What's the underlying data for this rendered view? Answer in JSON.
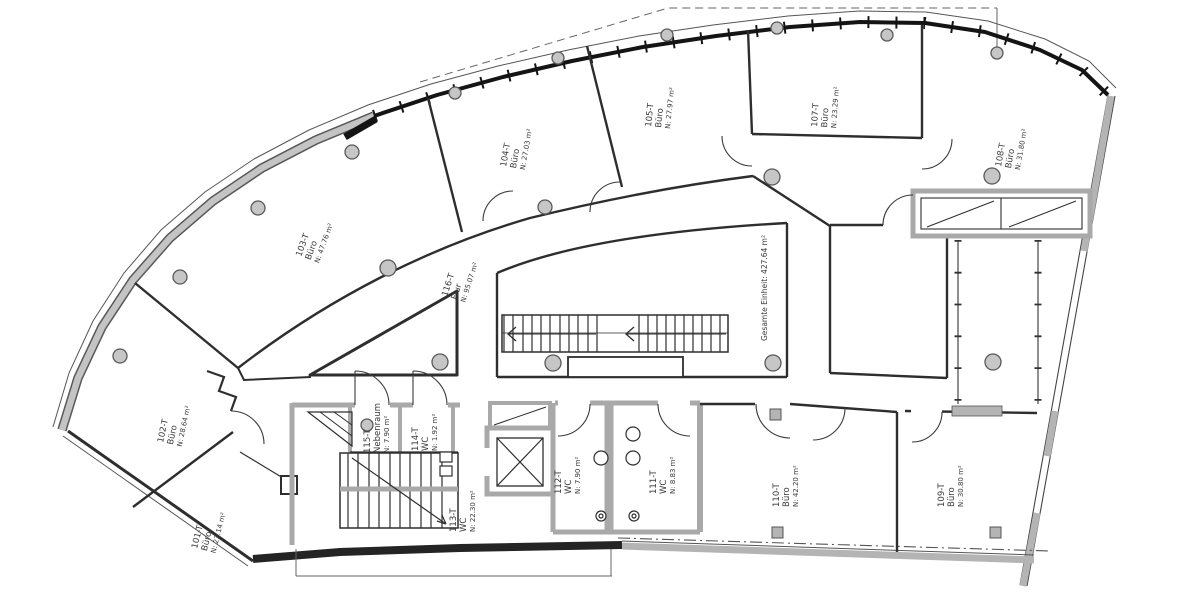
{
  "rooms": {
    "r101": {
      "id": "101-T",
      "type": "Büro",
      "area": "N: 23.14 m²"
    },
    "r102": {
      "id": "102-T",
      "type": "Büro",
      "area": "N: 28.64 m²"
    },
    "r103": {
      "id": "103-T",
      "type": "Büro",
      "area": "N: 47.76 m²"
    },
    "r104": {
      "id": "104-T",
      "type": "Büro",
      "area": "N: 27.03 m²"
    },
    "r105": {
      "id": "105-T",
      "type": "Büro",
      "area": "N: 27.97 m²"
    },
    "r107": {
      "id": "107-T",
      "type": "Büro",
      "area": "N: 23.29 m²"
    },
    "r108": {
      "id": "108-T",
      "type": "Büro",
      "area": "N: 31.80 m²"
    },
    "r109": {
      "id": "109-T",
      "type": "Büro",
      "area": "N: 30.80 m²"
    },
    "r110": {
      "id": "110-T",
      "type": "Büro",
      "area": "N: 42.20 m²"
    },
    "r111": {
      "id": "111-T",
      "type": "WC",
      "area": "N: 8.83 m²"
    },
    "r112": {
      "id": "112-T",
      "type": "WC",
      "area": "N: 7.90 m²"
    },
    "r113": {
      "id": "113-T",
      "type": "WC",
      "area": "N: 22.30 m²"
    },
    "r114": {
      "id": "114-T",
      "type": "WC",
      "area": "N: 1.92 m²"
    },
    "r115": {
      "id": "115-T",
      "type": "Nebenraum",
      "area": "N: 7.90 m²"
    },
    "r116": {
      "id": "116-T",
      "type": "Flur",
      "area": "N: 95.07 m²"
    }
  },
  "summary": {
    "total": "Gesamte Einheit: 427.64 m²"
  },
  "colors": {
    "line": "#2e2e2e",
    "wall_gray": "#b4b4b4",
    "curtain_wall": "#141414",
    "column_fill": "#c6c6c6"
  }
}
